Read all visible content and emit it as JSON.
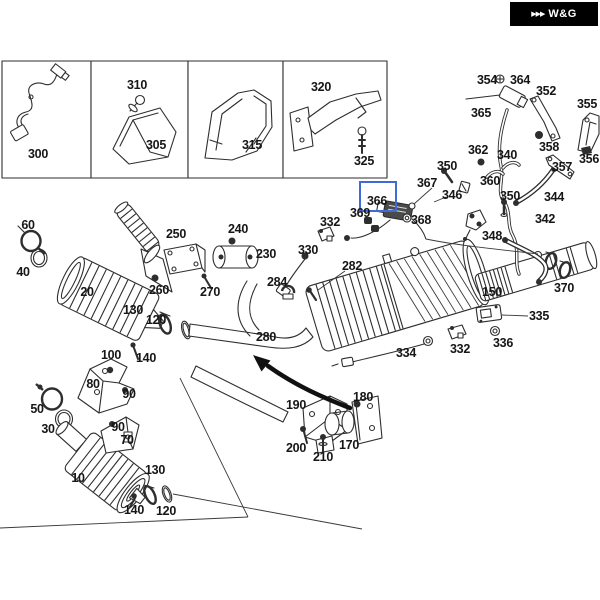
{
  "meta": {
    "width": 600,
    "height": 600,
    "background_color": "#ffffff"
  },
  "badge": {
    "logo_text": "W&G",
    "chevron_icon": "▶▶▶",
    "bg_color": "#000000",
    "text_color": "#ffffff",
    "x": 510,
    "y": 2,
    "width": 88,
    "height": 24
  },
  "highlight": {
    "part": "366",
    "border_color": "#3f6bd8",
    "x": 359,
    "y": 181,
    "width": 34,
    "height": 27
  },
  "inset_boxes": [
    {
      "id": "box-300",
      "parts": [
        "300"
      ]
    },
    {
      "id": "box-305-310",
      "parts": [
        "310",
        "305"
      ]
    },
    {
      "id": "box-315",
      "parts": [
        "315"
      ]
    },
    {
      "id": "box-320-325",
      "parts": [
        "320",
        "325"
      ]
    }
  ],
  "part_labels": [
    {
      "text": "300",
      "x": 38,
      "y": 154
    },
    {
      "text": "310",
      "x": 137,
      "y": 85
    },
    {
      "text": "305",
      "x": 156,
      "y": 145
    },
    {
      "text": "315",
      "x": 252,
      "y": 145
    },
    {
      "text": "320",
      "x": 321,
      "y": 87
    },
    {
      "text": "325",
      "x": 364,
      "y": 161
    },
    {
      "text": "354",
      "x": 487,
      "y": 80
    },
    {
      "text": "364",
      "x": 520,
      "y": 80
    },
    {
      "text": "365",
      "x": 481,
      "y": 113
    },
    {
      "text": "352",
      "x": 546,
      "y": 91
    },
    {
      "text": "355",
      "x": 587,
      "y": 104
    },
    {
      "text": "358",
      "x": 549,
      "y": 147
    },
    {
      "text": "362",
      "x": 478,
      "y": 150
    },
    {
      "text": "340",
      "x": 507,
      "y": 155
    },
    {
      "text": "350",
      "x": 447,
      "y": 166
    },
    {
      "text": "357",
      "x": 562,
      "y": 167
    },
    {
      "text": "356",
      "x": 589,
      "y": 159
    },
    {
      "text": "360",
      "x": 490,
      "y": 181
    },
    {
      "text": "346",
      "x": 452,
      "y": 195
    },
    {
      "text": "350",
      "x": 510,
      "y": 196
    },
    {
      "text": "344",
      "x": 554,
      "y": 197
    },
    {
      "text": "342",
      "x": 545,
      "y": 219
    },
    {
      "text": "348",
      "x": 492,
      "y": 236
    },
    {
      "text": "367",
      "x": 427,
      "y": 183
    },
    {
      "text": "366",
      "x": 377,
      "y": 201
    },
    {
      "text": "369",
      "x": 360,
      "y": 213
    },
    {
      "text": "368",
      "x": 421,
      "y": 220
    },
    {
      "text": "332",
      "x": 330,
      "y": 222
    },
    {
      "text": "330",
      "x": 308,
      "y": 250
    },
    {
      "text": "282",
      "x": 352,
      "y": 266
    },
    {
      "text": "284",
      "x": 277,
      "y": 282
    },
    {
      "text": "280",
      "x": 266,
      "y": 337
    },
    {
      "text": "60",
      "x": 28,
      "y": 225
    },
    {
      "text": "40",
      "x": 23,
      "y": 272
    },
    {
      "text": "20",
      "x": 87,
      "y": 292
    },
    {
      "text": "250",
      "x": 176,
      "y": 234
    },
    {
      "text": "240",
      "x": 238,
      "y": 229
    },
    {
      "text": "230",
      "x": 266,
      "y": 254
    },
    {
      "text": "260",
      "x": 159,
      "y": 290
    },
    {
      "text": "270",
      "x": 210,
      "y": 292
    },
    {
      "text": "130",
      "x": 133,
      "y": 310
    },
    {
      "text": "120",
      "x": 156,
      "y": 320
    },
    {
      "text": "100",
      "x": 111,
      "y": 355
    },
    {
      "text": "140",
      "x": 146,
      "y": 358
    },
    {
      "text": "80",
      "x": 93,
      "y": 384
    },
    {
      "text": "90",
      "x": 129,
      "y": 394
    },
    {
      "text": "90",
      "x": 118,
      "y": 427
    },
    {
      "text": "70",
      "x": 127,
      "y": 440
    },
    {
      "text": "50",
      "x": 37,
      "y": 409
    },
    {
      "text": "30",
      "x": 48,
      "y": 429
    },
    {
      "text": "10",
      "x": 78,
      "y": 478
    },
    {
      "text": "130",
      "x": 155,
      "y": 470
    },
    {
      "text": "140",
      "x": 134,
      "y": 510
    },
    {
      "text": "120",
      "x": 166,
      "y": 511
    },
    {
      "text": "190",
      "x": 296,
      "y": 405
    },
    {
      "text": "180",
      "x": 363,
      "y": 397
    },
    {
      "text": "200",
      "x": 296,
      "y": 448
    },
    {
      "text": "210",
      "x": 323,
      "y": 457
    },
    {
      "text": "170",
      "x": 349,
      "y": 445
    },
    {
      "text": "150",
      "x": 492,
      "y": 292
    },
    {
      "text": "370",
      "x": 564,
      "y": 288
    },
    {
      "text": "335",
      "x": 539,
      "y": 316
    },
    {
      "text": "336",
      "x": 503,
      "y": 343
    },
    {
      "text": "332",
      "x": 460,
      "y": 349
    },
    {
      "text": "334",
      "x": 406,
      "y": 353
    }
  ]
}
